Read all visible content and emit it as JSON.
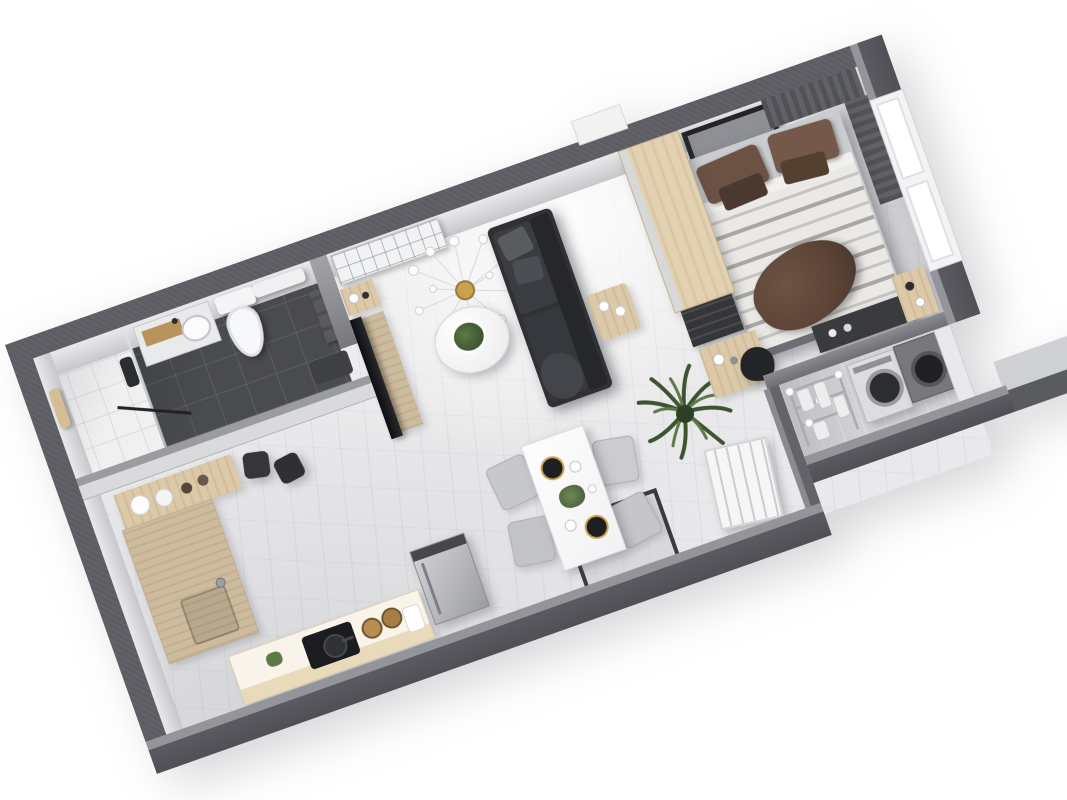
{
  "scene": {
    "kind": "3d-floorplan-render",
    "description": "Isometric 3D render of a studio apartment floor plan on a white background, rotated counter-clockwise",
    "rotation_deg": -19.5,
    "background": "#ffffff",
    "has_text": false
  },
  "palette": {
    "outer_wall": "#5c5d63",
    "wall_top_face": "#94959a",
    "inner_wall_face": "#d9dadc",
    "marble_floor": "#e9e9eb",
    "bathroom_tile": "#494b4f",
    "shower_tile": "#f0f0f1",
    "balcony_floor": "#d5d6d9",
    "wood_light": "#dcc9a7",
    "wood_counter": "#cdbb9e",
    "sofa_charcoal": "#2f3135",
    "bed_duvet": "#eae8e5",
    "pillow_brown": "#6b5244",
    "throw_brown": "#5d4437",
    "appliance_silver": "#c3c4c8",
    "plant_green": "#4e7040",
    "accent_gold": "#c9a24e",
    "curtain_gray": "#595a5f"
  },
  "rooms": [
    {
      "name": "bathroom",
      "furniture": [
        "walk-in-shower",
        "glass-partition",
        "towel",
        "shower-column",
        "vanity-sink",
        "toilet",
        "wall-shelf",
        "hanging-towels"
      ]
    },
    {
      "name": "kitchen",
      "furniture": [
        "canister-shelf",
        "bar-stools",
        "wood-countertop-with-sink",
        "island-counter",
        "cooktop-with-pan",
        "storage-jars",
        "herb-pot",
        "refrigerator"
      ]
    },
    {
      "name": "living-dining",
      "furniture": [
        "ac-unit",
        "wall-console",
        "tv",
        "sputnik-chandelier",
        "round-coffee-table-with-plant",
        "sofa",
        "gray-pillows",
        "side-table",
        "dining-table",
        "dining-chairs-x4",
        "dinner-plates",
        "entry-rug",
        "entry-door",
        "potted-plant"
      ]
    },
    {
      "name": "bedroom",
      "furniture": [
        "wardrobe",
        "shoe-shelf",
        "desk",
        "desk-chair",
        "double-bed",
        "brown-pillows",
        "striped-duvet",
        "brown-throw",
        "leaning-art-frame",
        "curtains",
        "windows",
        "media-console",
        "window-console"
      ]
    },
    {
      "name": "balcony",
      "furniture": [
        "drying-rack-with-laundry",
        "washing-machine",
        "dryer",
        "partition-cabinet",
        "outer-ledge"
      ]
    }
  ]
}
